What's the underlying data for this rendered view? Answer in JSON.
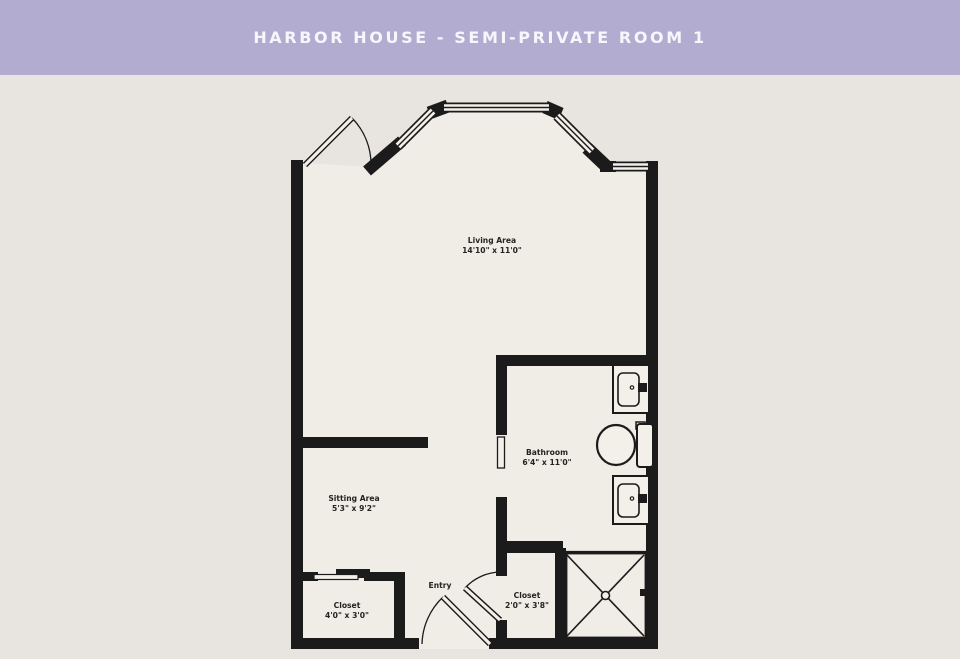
{
  "header": {
    "title": "HARBOR HOUSE - SEMI-PRIVATE ROOM 1",
    "background_color": "#b2acd1",
    "text_color": "#f8f6fc"
  },
  "colors": {
    "page_background": "#e8e4df",
    "floor": "#f0ece6",
    "wall": "#1b1b1b"
  },
  "rooms": {
    "living": {
      "name": "Living Area",
      "dims": "14'10\" x 11'0\""
    },
    "bathroom": {
      "name": "Bathroom",
      "dims": "6'4\" x 11'0\""
    },
    "sitting": {
      "name": "Sitting Area",
      "dims": "5'3\" x 9'2\""
    },
    "closet1": {
      "name": "Closet",
      "dims": "4'0\" x 3'0\""
    },
    "closet2": {
      "name": "Closet",
      "dims": "2'0\" x 3'8\""
    },
    "entry": {
      "name": "Entry"
    }
  }
}
